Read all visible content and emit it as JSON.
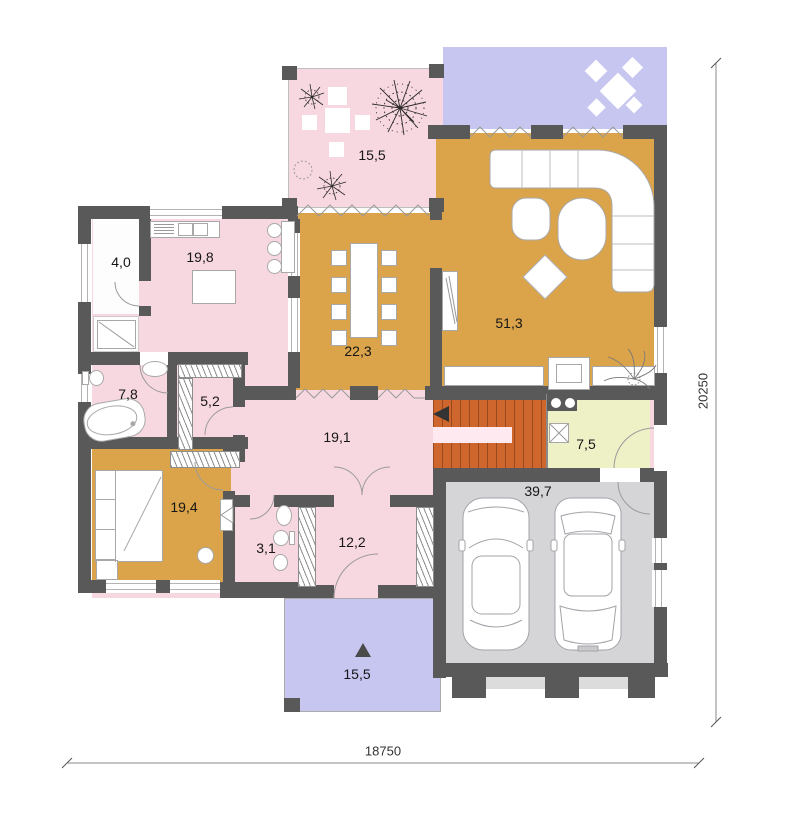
{
  "plan": {
    "title": "house ground floor plan",
    "rooms": [
      {
        "id": "winter-garden",
        "area": "15,5"
      },
      {
        "id": "kitchen",
        "area": "19,8"
      },
      {
        "id": "pantry",
        "area": "4,0"
      },
      {
        "id": "dining-room",
        "area": "22,3"
      },
      {
        "id": "living-room",
        "area": "51,3"
      },
      {
        "id": "bathroom",
        "area": "7,8"
      },
      {
        "id": "closet",
        "area": "5,2"
      },
      {
        "id": "hall",
        "area": "19,1"
      },
      {
        "id": "utility-room",
        "area": "7,5"
      },
      {
        "id": "bedroom",
        "area": "19,4"
      },
      {
        "id": "wc",
        "area": "3,1"
      },
      {
        "id": "room",
        "area": "12,2"
      },
      {
        "id": "garage",
        "area": "39,7"
      },
      {
        "id": "terrace",
        "area": "15,5"
      }
    ],
    "dimensions": {
      "bottom": "18750",
      "right": "20250"
    },
    "colors": {
      "wall": "#595959",
      "floor-pink": "#f8d8e0",
      "floor-orange": "#dba44a",
      "floor-lavender": "#c6c6f1",
      "floor-rust": "#ce662d",
      "floor-yellow": "#eef0c6",
      "floor-garage": "#d5d5d7",
      "garage-door": "#dcdcdc"
    }
  }
}
